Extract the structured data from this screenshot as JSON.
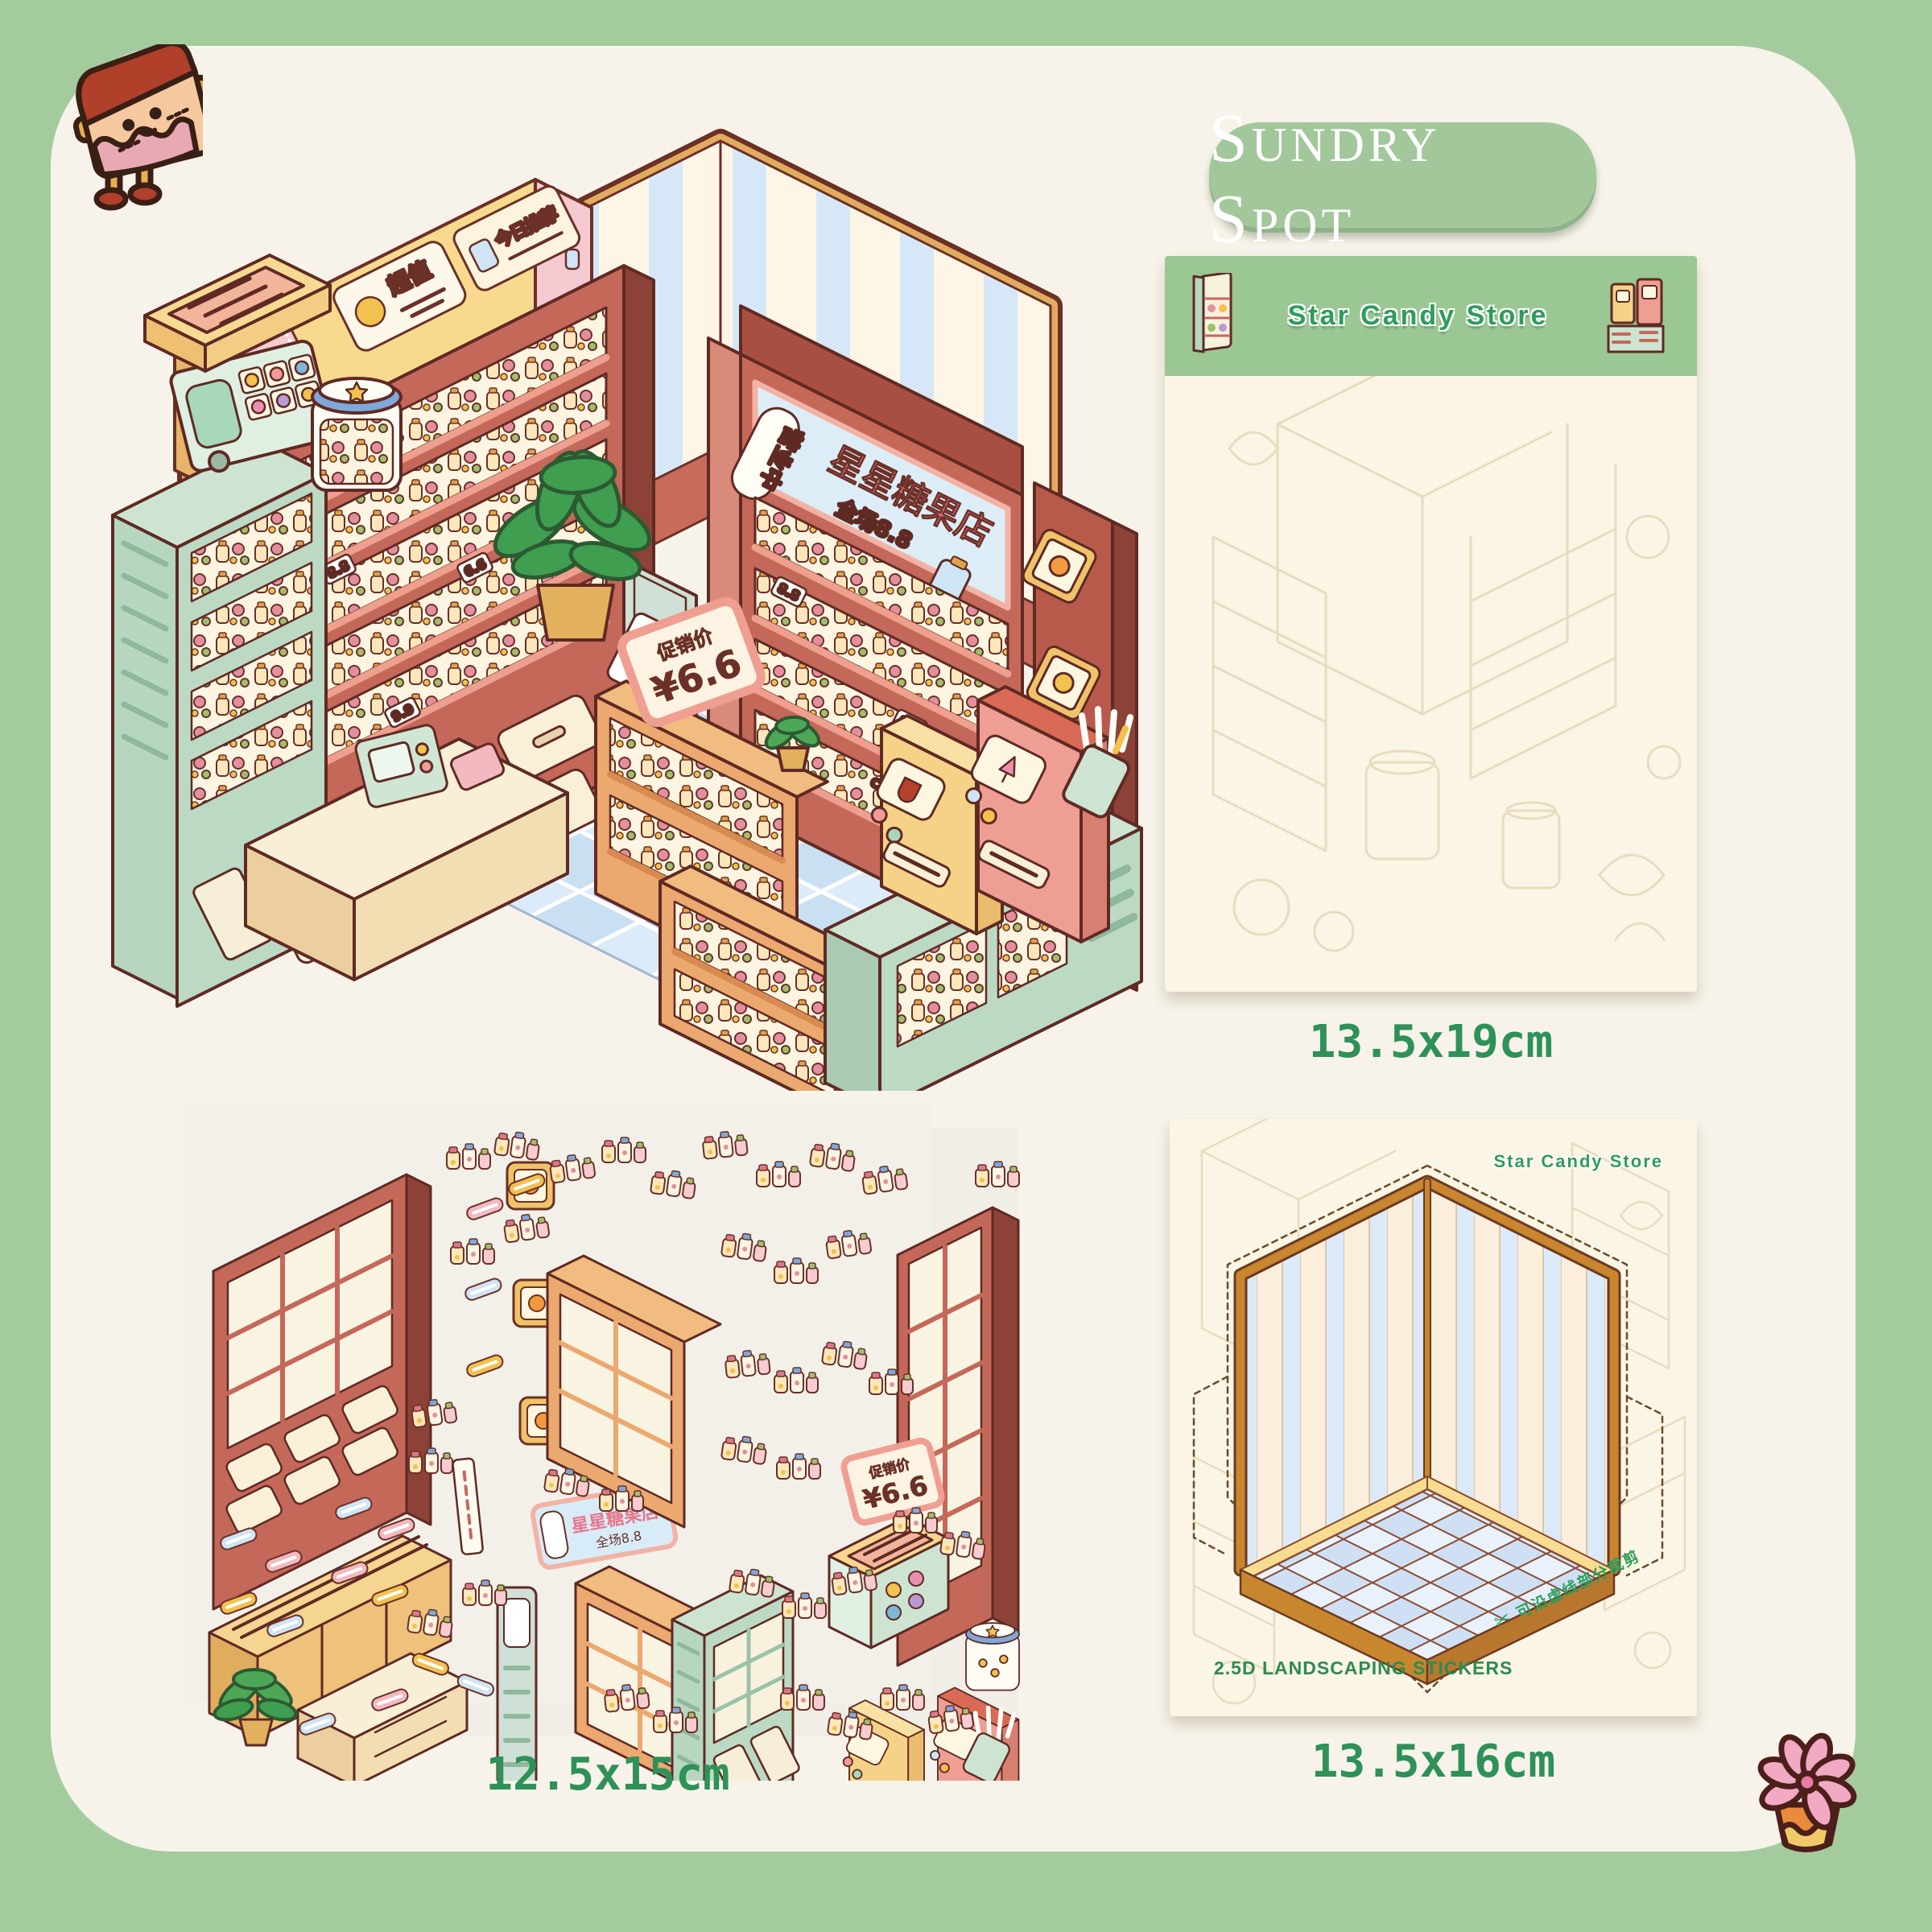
{
  "page": {
    "background": "#a4cb9e",
    "panel": "#f7f3ea"
  },
  "badge": {
    "label": "Sundry Spot",
    "background": "#a1c79a",
    "text_color": "#ffffff"
  },
  "captions": {
    "sheet_top_right": "13.5x19cm",
    "sheet_bottom_left": "12.5x15cm",
    "sheet_bottom_right": "13.5x16cm"
  },
  "sheets": {
    "top_right": {
      "header_title": "Star Candy Store",
      "header_color": "#9bc794"
    },
    "bottom_right": {
      "brand": "Star Candy Store",
      "type_label": "2.5D LANDSCAPING STICKERS",
      "cut_note": "可沿虚线部分裁剪",
      "scissors_icon": "✂"
    }
  },
  "store_signs": {
    "welcome": "欢迎光临",
    "super_value": "超值",
    "daily_pick": "今日推荐",
    "open": "营业中",
    "store_name": "星星糖果店",
    "storewide": "全场8.8",
    "promo_label": "促销价",
    "promo_price": "¥6.6",
    "self_service": "自助吧台冰水",
    "gdp_label": "GDP",
    "gdp_number": "21",
    "candy_box": "CANDY",
    "price_tags": [
      "8.8",
      "6.6",
      "9.9"
    ]
  },
  "mascots": {
    "top_left": "cake-slice-character",
    "bottom_right": "succulent-flower"
  },
  "colors": {
    "outline": "#5f2a23",
    "shelf_red": "#c4685a",
    "wall_cream": "#fdf6e6",
    "wall_blue": "#d6e8f7",
    "wood_yellow": "#f3cd83",
    "mint": "#bcd9c4",
    "floor_blue": "#cfe3f5",
    "caption_green": "#2e9158"
  }
}
